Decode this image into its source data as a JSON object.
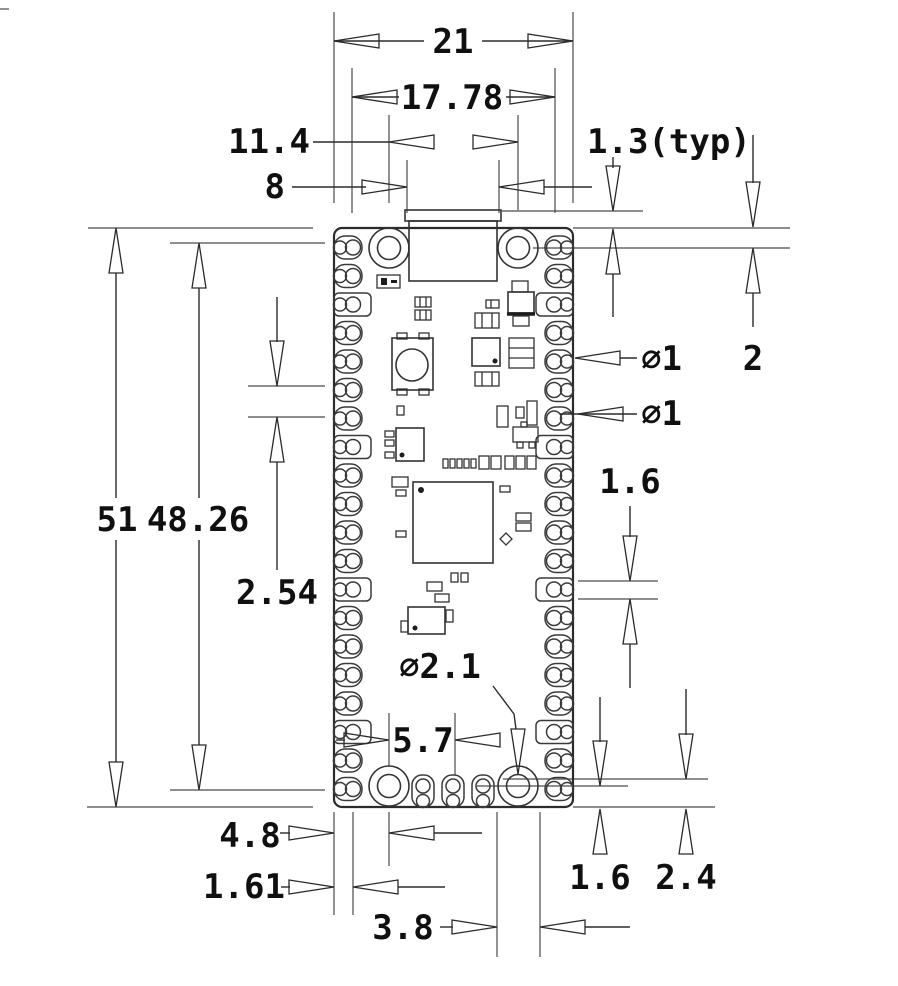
{
  "drawing": {
    "title": "pcb-module-dimension-drawing",
    "units": "mm",
    "colors": {
      "line": "#2b2b2b",
      "background": "#ffffff",
      "text": "#101010"
    },
    "labels": {
      "board_width": "21",
      "pin_row_span": "17.78",
      "hole_span": "11.4",
      "usb_width": "8",
      "usb_overhang": "1.3(typ)",
      "board_height": "51",
      "pin_column_span": "48.26",
      "pin_pitch": "2.54",
      "castellation_dia": "∅1",
      "pin_hole_dia": "∅1",
      "top_edge_to_pin": "2",
      "pad_width": "1.6",
      "mounting_hole_dia": "∅2.1",
      "hole_to_debug_pad": "5.7",
      "hole_offset_x": "4.8",
      "pin_edge_offset": "1.61",
      "debug_pad_span": "3.8",
      "bottom_pad_offset": "1.6",
      "bottom_pad_depth": "2.4"
    }
  }
}
